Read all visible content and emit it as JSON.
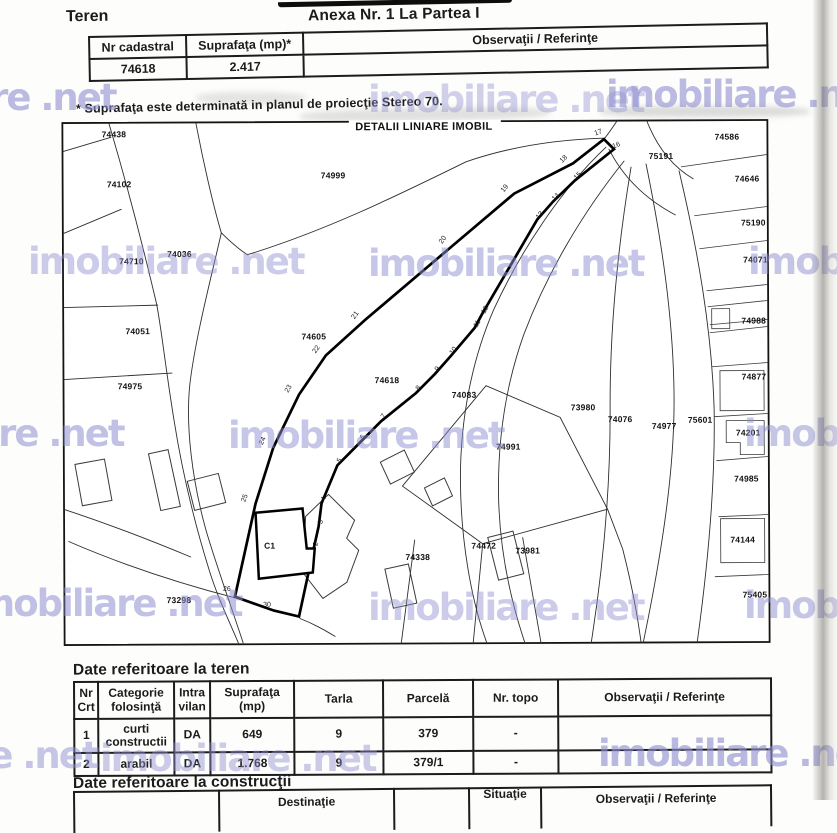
{
  "page": {
    "section_title": "Teren",
    "annex_title": "Anexa Nr. 1 La Partea I",
    "footnote": "* Suprafaţa este determinată in planul de proiecţie Stereo 70."
  },
  "cadastral_table": {
    "col_nr_cadastral": "Nr cadastral",
    "col_suprafata": "Suprafaţa (mp)*",
    "col_observatii": "Observaţii / Referinţe",
    "nr_cadastral": "74618",
    "suprafata": "2.417"
  },
  "map": {
    "title": "DETALII LINIARE IMOBIL",
    "building_label": "C1",
    "parcels": [
      {
        "label": "74438",
        "x": 53,
        "y": 16
      },
      {
        "label": "74102",
        "x": 58,
        "y": 66
      },
      {
        "label": "74036",
        "x": 118,
        "y": 136
      },
      {
        "label": "74710",
        "x": 70,
        "y": 143
      },
      {
        "label": "74051",
        "x": 76,
        "y": 213
      },
      {
        "label": "74975",
        "x": 68,
        "y": 268
      },
      {
        "label": "74999",
        "x": 272,
        "y": 58
      },
      {
        "label": "74605",
        "x": 252,
        "y": 219
      },
      {
        "label": "74618",
        "x": 325,
        "y": 263
      },
      {
        "label": "74083",
        "x": 402,
        "y": 278
      },
      {
        "label": "74991",
        "x": 446,
        "y": 330
      },
      {
        "label": "73980",
        "x": 521,
        "y": 291
      },
      {
        "label": "74076",
        "x": 558,
        "y": 303
      },
      {
        "label": "74977",
        "x": 602,
        "y": 310
      },
      {
        "label": "75601",
        "x": 638,
        "y": 304
      },
      {
        "label": "74201",
        "x": 686,
        "y": 317
      },
      {
        "label": "74586",
        "x": 666,
        "y": 21
      },
      {
        "label": "75191",
        "x": 600,
        "y": 40
      },
      {
        "label": "74646",
        "x": 686,
        "y": 63
      },
      {
        "label": "75190",
        "x": 692,
        "y": 107
      },
      {
        "label": "74071",
        "x": 694,
        "y": 144
      },
      {
        "label": "74988",
        "x": 692,
        "y": 205
      },
      {
        "label": "74877",
        "x": 692,
        "y": 261
      },
      {
        "label": "74985",
        "x": 684,
        "y": 363
      },
      {
        "label": "74144",
        "x": 680,
        "y": 424
      },
      {
        "label": "75405",
        "x": 692,
        "y": 479
      },
      {
        "label": "74338",
        "x": 355,
        "y": 440
      },
      {
        "label": "74472",
        "x": 421,
        "y": 429
      },
      {
        "label": "73981",
        "x": 465,
        "y": 434
      },
      {
        "label": "73298",
        "x": 116,
        "y": 482
      }
    ],
    "vertices": [
      {
        "n": "17",
        "x": 538,
        "y": 15,
        "r": -20
      },
      {
        "n": "16",
        "x": 556,
        "y": 28,
        "r": -20
      },
      {
        "n": "18",
        "x": 504,
        "y": 41,
        "r": -45
      },
      {
        "n": "15",
        "x": 518,
        "y": 58,
        "r": -45
      },
      {
        "n": "19",
        "x": 445,
        "y": 70,
        "r": -50
      },
      {
        "n": "14",
        "x": 496,
        "y": 79,
        "r": -45
      },
      {
        "n": "13",
        "x": 480,
        "y": 97,
        "r": -50
      },
      {
        "n": "20",
        "x": 383,
        "y": 121,
        "r": -55
      },
      {
        "n": "12",
        "x": 425,
        "y": 191,
        "r": -60
      },
      {
        "n": "11",
        "x": 417,
        "y": 205,
        "r": -60
      },
      {
        "n": "21",
        "x": 295,
        "y": 196,
        "r": -55
      },
      {
        "n": "10",
        "x": 393,
        "y": 232,
        "r": -55
      },
      {
        "n": "9",
        "x": 377,
        "y": 250,
        "r": -55
      },
      {
        "n": "22",
        "x": 256,
        "y": 230,
        "r": -55
      },
      {
        "n": "8",
        "x": 358,
        "y": 269,
        "r": -55
      },
      {
        "n": "23",
        "x": 228,
        "y": 269,
        "r": -60
      },
      {
        "n": "7",
        "x": 323,
        "y": 297,
        "r": -55
      },
      {
        "n": "6",
        "x": 302,
        "y": 318,
        "r": -55
      },
      {
        "n": "24",
        "x": 202,
        "y": 321,
        "r": -65
      },
      {
        "n": "5",
        "x": 279,
        "y": 341,
        "r": -60
      },
      {
        "n": "4",
        "x": 263,
        "y": 379,
        "r": -70
      },
      {
        "n": "25",
        "x": 184,
        "y": 378,
        "r": -70
      },
      {
        "n": "3",
        "x": 260,
        "y": 402,
        "r": -75
      },
      {
        "n": "2",
        "x": 255,
        "y": 424,
        "r": -75
      },
      {
        "n": "26",
        "x": 164,
        "y": 470,
        "r": 0
      },
      {
        "n": "30",
        "x": 204,
        "y": 486,
        "r": 0
      }
    ]
  },
  "teren_table": {
    "heading": "Date referitoare la teren",
    "headers": [
      "Nr Crt",
      "Categorie folosinţă",
      "Intra vilan",
      "Suprafaţa (mp)",
      "Tarla",
      "Parcelă",
      "Nr. topo",
      "Observaţii / Referinţe"
    ],
    "rows": [
      {
        "nr": "1",
        "categorie": "curti constructii",
        "intravilan": "DA",
        "suprafata": "649",
        "tarla": "9",
        "parcela": "379",
        "nrtopo": "-",
        "obs": ""
      },
      {
        "nr": "2",
        "categorie": "arabil",
        "intravilan": "DA",
        "suprafata": "1.768",
        "tarla": "9",
        "parcela": "379/1",
        "nrtopo": "-",
        "obs": ""
      }
    ]
  },
  "constructii_table": {
    "heading": "Date referitoare la construcţii",
    "headers": [
      "",
      "Destinaţie",
      "",
      "Situaţie",
      "Observaţii / Referinţe"
    ]
  },
  "watermark": {
    "text": "imobiliare .net",
    "color": "#8f8fd2",
    "positions": [
      {
        "x": -160,
        "y": 76,
        "o": 0.6
      },
      {
        "x": 368,
        "y": 78,
        "o": 0.4
      },
      {
        "x": 606,
        "y": 73,
        "o": 0.6
      },
      {
        "x": 28,
        "y": 240,
        "o": 0.45
      },
      {
        "x": 368,
        "y": 242,
        "o": 0.5
      },
      {
        "x": 748,
        "y": 240,
        "o": 0.5
      },
      {
        "x": -152,
        "y": 412,
        "o": 0.55
      },
      {
        "x": 228,
        "y": 414,
        "o": 0.5
      },
      {
        "x": 744,
        "y": 412,
        "o": 0.5
      },
      {
        "x": -34,
        "y": 582,
        "o": 0.55
      },
      {
        "x": 368,
        "y": 586,
        "o": 0.45
      },
      {
        "x": 744,
        "y": 584,
        "o": 0.5
      },
      {
        "x": -178,
        "y": 734,
        "o": 0.5
      },
      {
        "x": 100,
        "y": 737,
        "o": 0.45
      },
      {
        "x": 598,
        "y": 732,
        "o": 0.62
      }
    ]
  }
}
